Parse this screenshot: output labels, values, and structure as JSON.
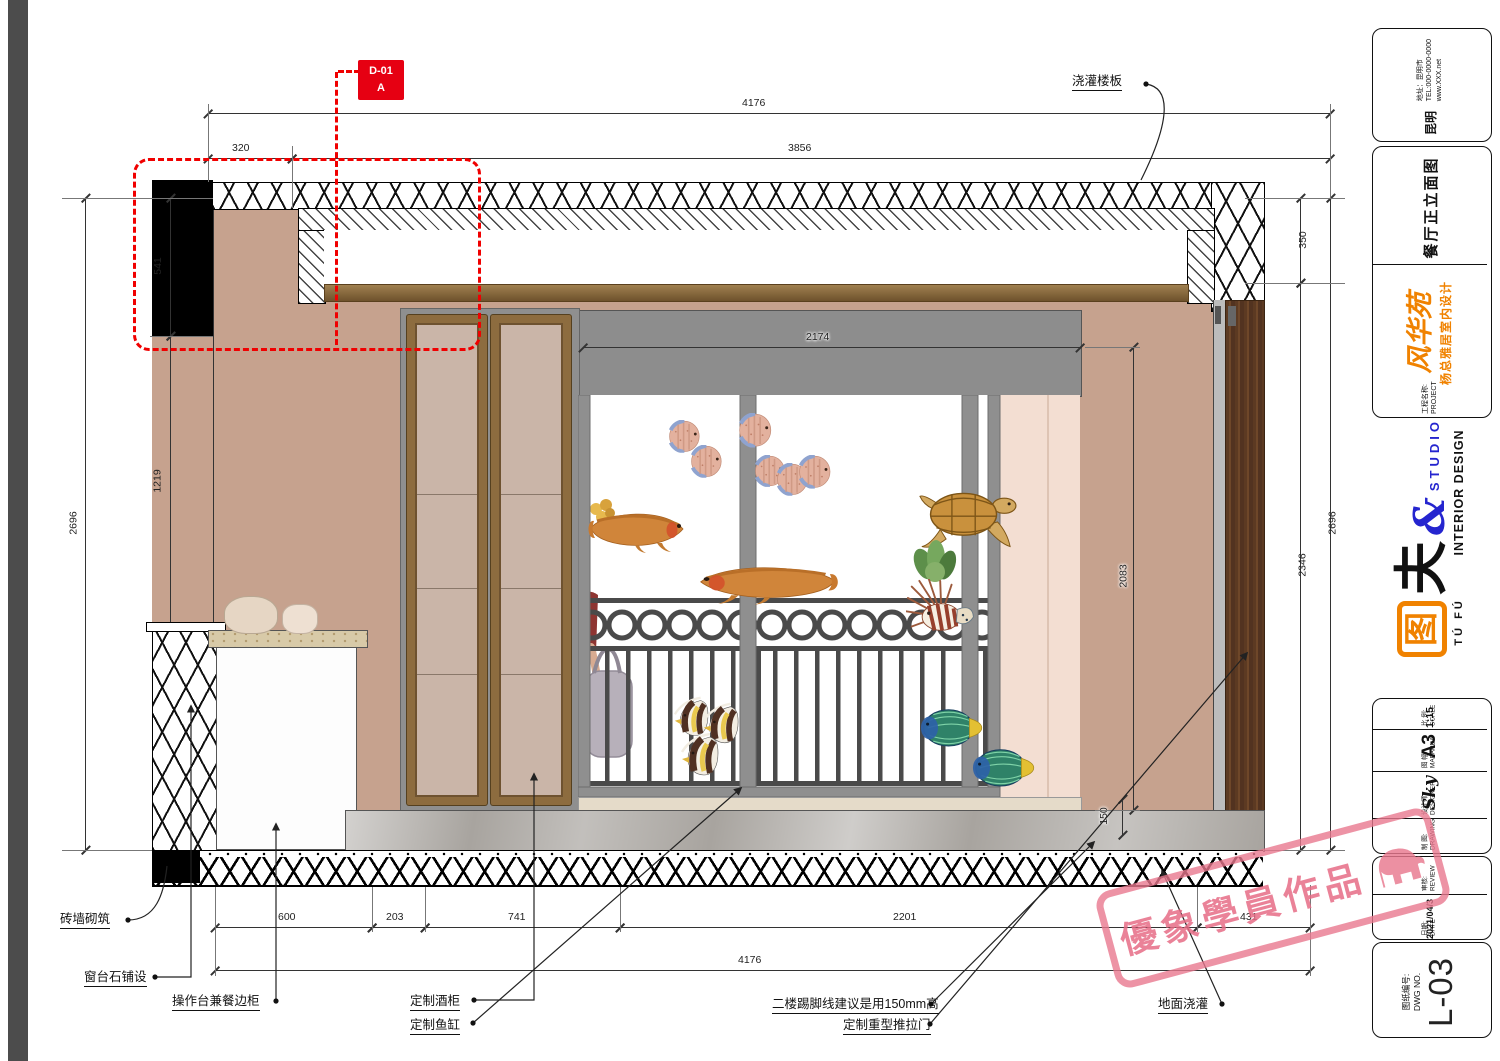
{
  "drawing": {
    "callout": {
      "code": "D-01",
      "zone": "A"
    },
    "annotations": {
      "slab": "浇灌楼板",
      "brick": "砖墙砌筑",
      "sill": "窗台石铺设",
      "counter": "操作台兼餐边柜",
      "wine": "定制酒柜",
      "tank": "定制鱼缸",
      "skirting": "二楼踢脚线建议是用150mm高",
      "door": "定制重型推拉门",
      "floor": "地面浇灌"
    },
    "dims": {
      "top_total": "4176",
      "top_a": "320",
      "top_b": "3856",
      "left_total": "2696",
      "left_a": "541",
      "left_b": "1219",
      "left_c": "936",
      "right_a": "350",
      "right_b": "2346",
      "right_total": "2696",
      "tank_w": "2174",
      "tank_h": "2083",
      "skirt_h": "150",
      "bot_a": "600",
      "bot_b": "203",
      "bot_c": "741",
      "bot_d": "2201",
      "bot_e": "431",
      "bot_total": "4176"
    }
  },
  "titleblock": {
    "contact": {
      "region": "昆明",
      "address": "地址：昆明市",
      "tel": "TEL:000-0000-0000",
      "web": "www.XXX.net"
    },
    "project": {
      "label_cn": "工程名称:",
      "label_en": "PROJECT",
      "brand": "风华苑",
      "subtitle": "杨总雅居室内设计",
      "drawing_title": "餐厅正立面图"
    },
    "logo": {
      "tu": "图",
      "fu": "夫",
      "amp": "&",
      "studio": "STUDIO",
      "pinyin": "TÚ FÚ",
      "tagline": "INTERIOR DESIGN"
    },
    "info": {
      "draw_cn": "制 图:",
      "draw_en": "DRAWING",
      "designer_cn": "设计师:",
      "designer_en": "DESIGNER",
      "designer": "Sky",
      "size_cn": "图 幅:",
      "size_en": "MAPAREA",
      "size": "A3",
      "scale_cn": "比 例:",
      "scale_en": "SCALE",
      "scale": "1:15"
    },
    "meta": {
      "date_cn": "日期:",
      "date_en": "DATE",
      "date": "2021/04/3",
      "review_cn": "审核:",
      "review_en": "REVIEW"
    },
    "dwg": {
      "label_cn": "图纸编号:",
      "label_en": "DWG NO.",
      "number": "L-03"
    }
  },
  "watermark": {
    "text": "優象學員作品"
  },
  "colors": {
    "accent_red": "#e60012",
    "brand_orange": "#f08200",
    "logo_blue": "#2525cf",
    "watermark_pink": "#e87e96",
    "wall_tan": "#c6a28e"
  }
}
